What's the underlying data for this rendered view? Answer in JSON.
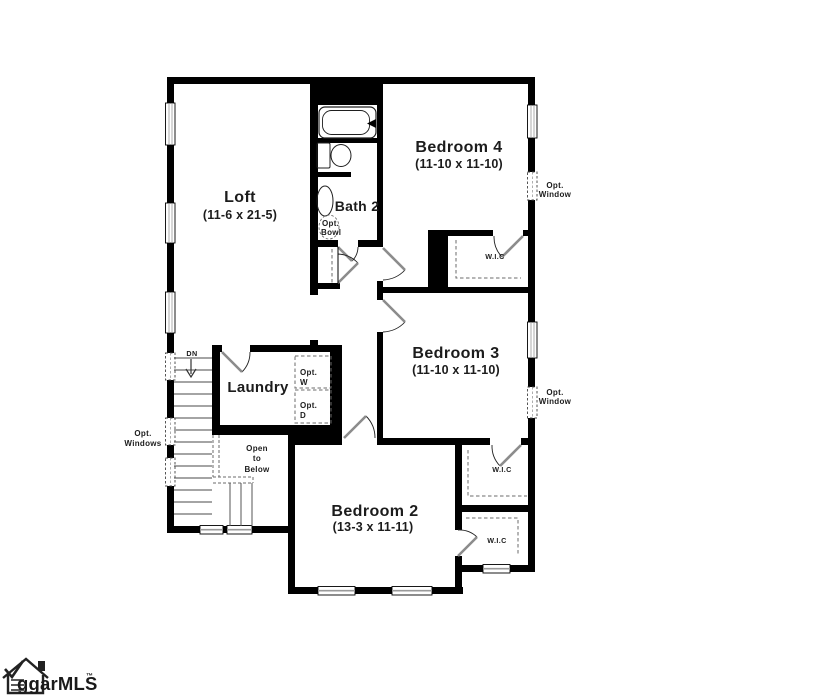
{
  "colors": {
    "background": "#ffffff",
    "wall": "#000000",
    "door_leaf": "#8c8c8c",
    "door_arc": "#1f1f1f",
    "window_line": "#9a9a9a",
    "dashed_line": "#6b6b6b",
    "text": "#1c1c1c"
  },
  "rooms": {
    "loft": {
      "name": "Loft",
      "dims": "(11-6 x 21-5)"
    },
    "bath2": {
      "name": "Bath 2"
    },
    "bedroom4": {
      "name": "Bedroom 4",
      "dims": "(11-10 x 11-10)"
    },
    "bedroom3": {
      "name": "Bedroom 3",
      "dims": "(11-10 x 11-10)"
    },
    "bedroom2": {
      "name": "Bedroom 2",
      "dims": "(13-3 x 11-11)"
    },
    "laundry": {
      "name": "Laundry"
    },
    "wic_bedroom4": {
      "name": "W.I.C"
    },
    "wic_bedroom3": {
      "name": "W.I.C"
    },
    "wic_bedroom2": {
      "name": "W.I.C"
    }
  },
  "annotations": {
    "down": "DN",
    "open_to_below": {
      "l1": "Open",
      "l2": "to",
      "l3": "Below"
    },
    "opt_bowl": {
      "l1": "Opt.",
      "l2": "Bowl"
    },
    "opt_washer": {
      "l1": "Opt.",
      "l2": "W"
    },
    "opt_dryer": {
      "l1": "Opt.",
      "l2": "D"
    },
    "opt_window_right_upper": {
      "l1": "Opt.",
      "l2": "Window"
    },
    "opt_window_right_lower": {
      "l1": "Opt.",
      "l2": "Window"
    },
    "opt_windows_left": {
      "l1": "Opt.",
      "l2": "Windows"
    }
  },
  "logo": {
    "text": "ggarMLS",
    "tm": "™"
  }
}
